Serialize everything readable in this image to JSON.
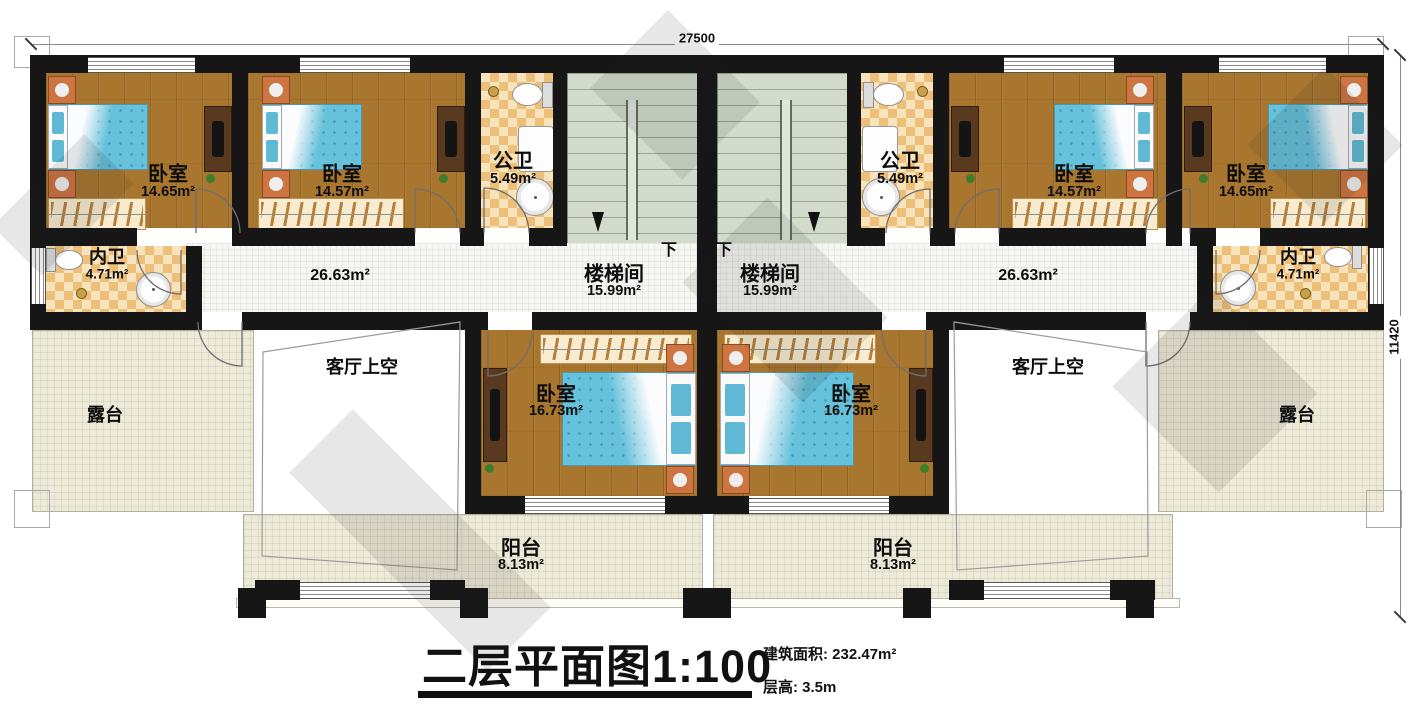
{
  "dimensions": {
    "width": "27500",
    "height": "11420"
  },
  "title": {
    "text": "二层平面图",
    "scale": "1:100",
    "area_note": "建筑面积: 232.47m²",
    "height_note": "层高: 3.5m"
  },
  "stairs": {
    "down": "下"
  },
  "rooms": {
    "bedroom_a": {
      "name": "卧室",
      "area": "14.65m²"
    },
    "bedroom_b": {
      "name": "卧室",
      "area": "14.57m²"
    },
    "bath_pub_l": {
      "name": "公卫",
      "area": "5.49m²"
    },
    "stair_l": {
      "name": "楼梯间",
      "area": "15.99m²"
    },
    "stair_r": {
      "name": "楼梯间",
      "area": "15.99m²"
    },
    "bath_pub_r": {
      "name": "公卫",
      "area": "5.49m²"
    },
    "bedroom_c": {
      "name": "卧室",
      "area": "14.57m²"
    },
    "bedroom_d": {
      "name": "卧室",
      "area": "14.65m²"
    },
    "bath_en_l": {
      "name": "内卫",
      "area": "4.71m²"
    },
    "bath_en_r": {
      "name": "内卫",
      "area": "4.71m²"
    },
    "corridor_l": {
      "area": "26.63m²"
    },
    "corridor_r": {
      "area": "26.63m²"
    },
    "terrace_l": {
      "name": "露台"
    },
    "terrace_r": {
      "name": "露台"
    },
    "void_l": {
      "name": "客厅上空"
    },
    "void_r": {
      "name": "客厅上空"
    },
    "bedroom_e": {
      "name": "卧室",
      "area": "16.73m²"
    },
    "bedroom_f": {
      "name": "卧室",
      "area": "16.73m²"
    },
    "balcony_l": {
      "name": "阳台",
      "area": "8.13m²"
    },
    "balcony_r": {
      "name": "阳台",
      "area": "8.13m²"
    }
  }
}
